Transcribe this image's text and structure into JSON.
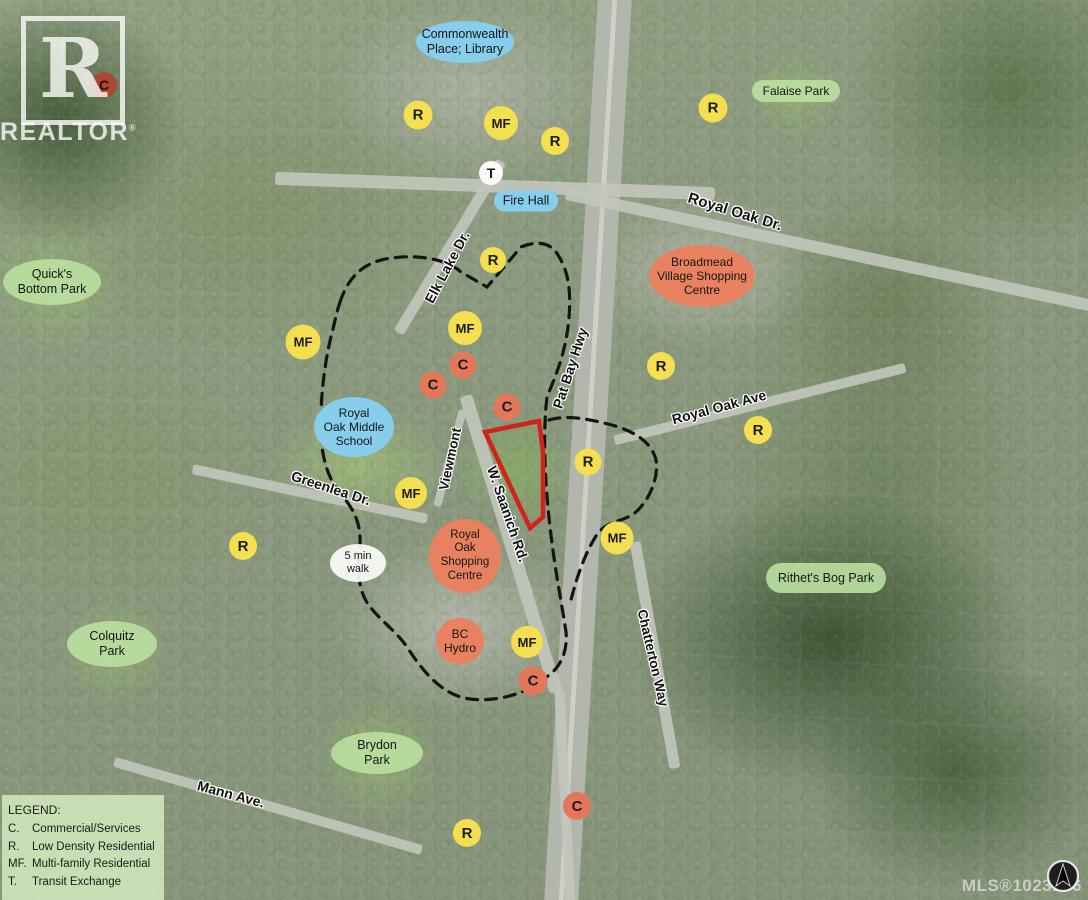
{
  "map": {
    "width": 1088,
    "height": 900,
    "mls_text": "MLS®1023186",
    "logo": {
      "letter": "R",
      "word": "REALTOR",
      "reg": "®"
    }
  },
  "colors": {
    "marker_yellow": "#f3df4f",
    "marker_salmon": "#e4775a",
    "marker_red": "#a94a30",
    "label_blue": "#87cdec",
    "label_salmon": "#e8815f",
    "label_green": "#bae0a0",
    "property_outline": "#d0241b",
    "walk_boundary": "#141414"
  },
  "legend": {
    "title": "LEGEND:",
    "items": [
      {
        "key": "C.",
        "label": "Commercial/Services"
      },
      {
        "key": "R.",
        "label": "Low Density Residential"
      },
      {
        "key": "MF.",
        "label": "Multi-family Residential"
      },
      {
        "key": "T.",
        "label": "Transit Exchange"
      }
    ]
  },
  "markers": [
    {
      "letter": "C",
      "x": 104,
      "y": 85,
      "d": 26,
      "variant": "red",
      "fs": 14
    },
    {
      "letter": "R",
      "x": 418,
      "y": 115,
      "d": 29,
      "variant": "yellow",
      "fs": 15
    },
    {
      "letter": "MF",
      "x": 501,
      "y": 123,
      "d": 34,
      "variant": "yellow",
      "fs": 13
    },
    {
      "letter": "R",
      "x": 555,
      "y": 141,
      "d": 28,
      "variant": "yellow",
      "fs": 15
    },
    {
      "letter": "T",
      "x": 491,
      "y": 173,
      "d": 24,
      "variant": "white",
      "fs": 14
    },
    {
      "letter": "R",
      "x": 713,
      "y": 108,
      "d": 29,
      "variant": "yellow",
      "fs": 15
    },
    {
      "letter": "R",
      "x": 493,
      "y": 260,
      "d": 26,
      "variant": "yellow",
      "fs": 15
    },
    {
      "letter": "MF",
      "x": 303,
      "y": 342,
      "d": 35,
      "variant": "yellow",
      "fs": 13
    },
    {
      "letter": "MF",
      "x": 465,
      "y": 328,
      "d": 34,
      "variant": "yellow",
      "fs": 13
    },
    {
      "letter": "C",
      "x": 463,
      "y": 365,
      "d": 27,
      "variant": "salmon",
      "fs": 15
    },
    {
      "letter": "C",
      "x": 433,
      "y": 385,
      "d": 27,
      "variant": "salmon",
      "fs": 15
    },
    {
      "letter": "C",
      "x": 507,
      "y": 407,
      "d": 27,
      "variant": "salmon",
      "fs": 15
    },
    {
      "letter": "R",
      "x": 661,
      "y": 366,
      "d": 28,
      "variant": "yellow",
      "fs": 15
    },
    {
      "letter": "R",
      "x": 758,
      "y": 430,
      "d": 28,
      "variant": "yellow",
      "fs": 15
    },
    {
      "letter": "R",
      "x": 588,
      "y": 462,
      "d": 27,
      "variant": "yellow",
      "fs": 15
    },
    {
      "letter": "MF",
      "x": 411,
      "y": 493,
      "d": 32,
      "variant": "yellow",
      "fs": 13
    },
    {
      "letter": "R",
      "x": 243,
      "y": 546,
      "d": 28,
      "variant": "yellow",
      "fs": 15
    },
    {
      "letter": "MF",
      "x": 617,
      "y": 538,
      "d": 33,
      "variant": "yellow",
      "fs": 13
    },
    {
      "letter": "MF",
      "x": 527,
      "y": 642,
      "d": 32,
      "variant": "yellow",
      "fs": 13
    },
    {
      "letter": "C",
      "x": 533,
      "y": 681,
      "d": 29,
      "variant": "salmon",
      "fs": 15
    },
    {
      "letter": "C",
      "x": 577,
      "y": 806,
      "d": 28,
      "variant": "salmon",
      "fs": 15
    },
    {
      "letter": "R",
      "x": 467,
      "y": 833,
      "d": 28,
      "variant": "yellow",
      "fs": 15
    }
  ],
  "place_labels": [
    {
      "id": "commonwealth-place-library",
      "lines": [
        "Commonwealth",
        "Place; Library"
      ],
      "x": 465,
      "y": 42,
      "w": 98,
      "h": 42,
      "variant": "blue",
      "shape": "ellipse",
      "fs": 12.5
    },
    {
      "id": "fire-hall",
      "lines": [
        "Fire Hall"
      ],
      "x": 526,
      "y": 201,
      "w": 64,
      "h": 21,
      "variant": "blue",
      "shape": "pill",
      "fs": 12.5
    },
    {
      "id": "royal-oak-middle-school",
      "lines": [
        "Royal",
        "Oak Middle",
        "School"
      ],
      "x": 354,
      "y": 427,
      "w": 80,
      "h": 60,
      "variant": "blue",
      "shape": "ellipse",
      "fs": 12
    },
    {
      "id": "broadmead-village-shopping-centre",
      "lines": [
        "Broadmead",
        "Village Shopping",
        "Centre"
      ],
      "x": 702,
      "y": 276,
      "w": 106,
      "h": 62,
      "variant": "salmon",
      "shape": "ellipse",
      "fs": 12
    },
    {
      "id": "royal-oak-shopping-centre",
      "lines": [
        "Royal",
        "Oak",
        "Shopping",
        "Centre"
      ],
      "x": 465,
      "y": 556,
      "w": 72,
      "h": 74,
      "variant": "salmon",
      "shape": "ellipse",
      "fs": 11.5
    },
    {
      "id": "bc-hydro",
      "lines": [
        "BC",
        "Hydro"
      ],
      "x": 460,
      "y": 641,
      "w": 48,
      "h": 46,
      "variant": "salmon",
      "shape": "ellipse",
      "fs": 12
    },
    {
      "id": "falaise-park",
      "lines": [
        "Falaise Park"
      ],
      "x": 796,
      "y": 91,
      "w": 88,
      "h": 22,
      "variant": "green",
      "shape": "pill",
      "fs": 12
    },
    {
      "id": "quicks-bottom-park",
      "lines": [
        "Quick's",
        "Bottom Park"
      ],
      "x": 52,
      "y": 282,
      "w": 98,
      "h": 46,
      "variant": "green",
      "shape": "ellipse",
      "fs": 12.5
    },
    {
      "id": "rithets-bog-park",
      "lines": [
        "Rithet's Bog Park"
      ],
      "x": 826,
      "y": 578,
      "w": 120,
      "h": 30,
      "variant": "green",
      "shape": "pill",
      "fs": 12.5
    },
    {
      "id": "colquitz-park",
      "lines": [
        "Colquitz",
        "Park"
      ],
      "x": 112,
      "y": 644,
      "w": 90,
      "h": 46,
      "variant": "green",
      "shape": "ellipse",
      "fs": 12.5
    },
    {
      "id": "brydon-park",
      "lines": [
        "Brydon",
        "Park"
      ],
      "x": 377,
      "y": 753,
      "w": 92,
      "h": 42,
      "variant": "green",
      "shape": "ellipse",
      "fs": 12.5
    },
    {
      "id": "five-min-walk",
      "lines": [
        "5 min",
        "walk"
      ],
      "x": 358,
      "y": 563,
      "w": 56,
      "h": 38,
      "variant": "white",
      "shape": "ellipse",
      "fs": 11
    }
  ],
  "road_labels": [
    {
      "id": "royal-oak-dr",
      "text": "Royal Oak Dr.",
      "x": 735,
      "y": 212,
      "rot": 17,
      "fs": 15
    },
    {
      "id": "elk-lake-dr",
      "text": "Elk Lake Dr.",
      "x": 447,
      "y": 267,
      "rot": -62,
      "fs": 14
    },
    {
      "id": "pat-bay-hwy",
      "text": "Pat Bay Hwy",
      "x": 570,
      "y": 368,
      "rot": -72,
      "fs": 14
    },
    {
      "id": "royal-oak-ave",
      "text": "Royal Oak Ave",
      "x": 719,
      "y": 407,
      "rot": -15,
      "fs": 14
    },
    {
      "id": "w-saanich-rd",
      "text": "W. Saanich Rd.",
      "x": 508,
      "y": 514,
      "rot": 71,
      "fs": 14
    },
    {
      "id": "viewmont",
      "text": "Viewmont",
      "x": 450,
      "y": 459,
      "rot": -78,
      "fs": 13.5
    },
    {
      "id": "greenlea-dr",
      "text": "Greenlea Dr.",
      "x": 331,
      "y": 488,
      "rot": 18,
      "fs": 14
    },
    {
      "id": "chatterton-way",
      "text": "Chatterton Way",
      "x": 653,
      "y": 658,
      "rot": 77,
      "fs": 13.5
    },
    {
      "id": "mann-ave",
      "text": "Mann Ave.",
      "x": 231,
      "y": 794,
      "rot": 15,
      "fs": 14
    }
  ],
  "overlays": {
    "walk_boundary_path": "M340,302 C350,272 368,261 392,258 C420,254 448,260 461,272 L487,287 L521,247 C538,240 551,243 558,255 C569,272 571,292 569,318 C566,352 556,375 547,397 C543,430 544,480 551,535 C555,570 562,605 566,632 C568,655 558,670 545,678 C525,695 495,702 470,699 C444,696 424,673 409,650 C397,631 379,620 368,604 C356,587 358,560 360,543 C361,520 351,506 340,493 C326,476 321,452 321,430 C320,394 326,354 333,329 C336,316 337,311 340,302 Z",
    "walk_boundary_lobe": "M549,420 C565,415 585,418 608,424 C636,431 652,443 656,460 C659,480 648,501 636,512 C622,523 606,520 596,536 C584,555 576,580 571,600",
    "property_points": "485,432 539,421 543,452 543,517 530,528"
  }
}
